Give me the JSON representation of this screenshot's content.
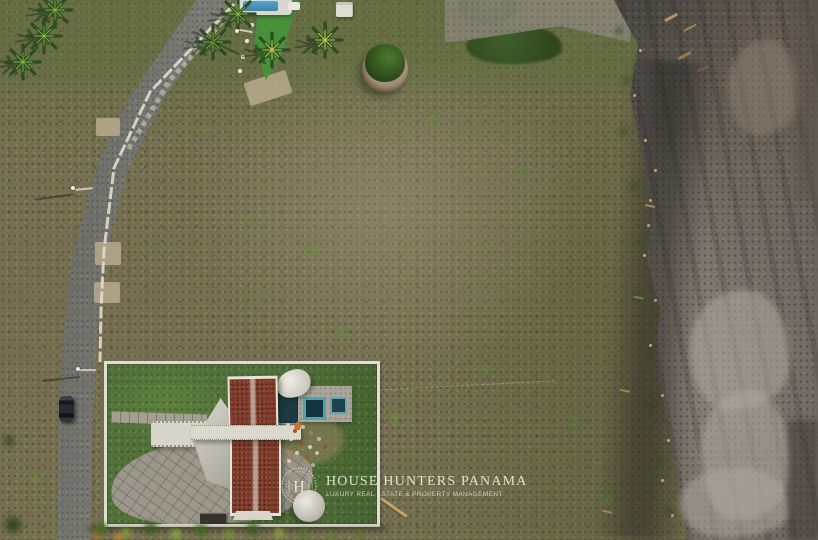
{
  "branding": {
    "monogram_letter": "H",
    "title": "HOUSE HUNTERS PANAMA",
    "tagline": "LUXURY REAL ESTATE & PROPERTY MANAGEMENT",
    "text_color": "#ece7d8"
  },
  "scene": {
    "type": "aerial-drone-photo",
    "regions": [
      "access-road",
      "vacant-beachfront-lot",
      "lawn-with-palms-and-pool",
      "walled-villa-compound",
      "dark-sand-beach"
    ],
    "colors": {
      "lot_scrub": "#767052",
      "lawn_green": "#3f8436",
      "road_asphalt": "#7e7f78",
      "beach_dark_sand": "#5f5b55",
      "beach_light_sand": "#9a948a",
      "roof_tile_red": "#7a3b2c",
      "pool_blue": "#3c82ab",
      "casita_blue": "#5b9dac",
      "wall_white": "#e0ddd2"
    }
  }
}
